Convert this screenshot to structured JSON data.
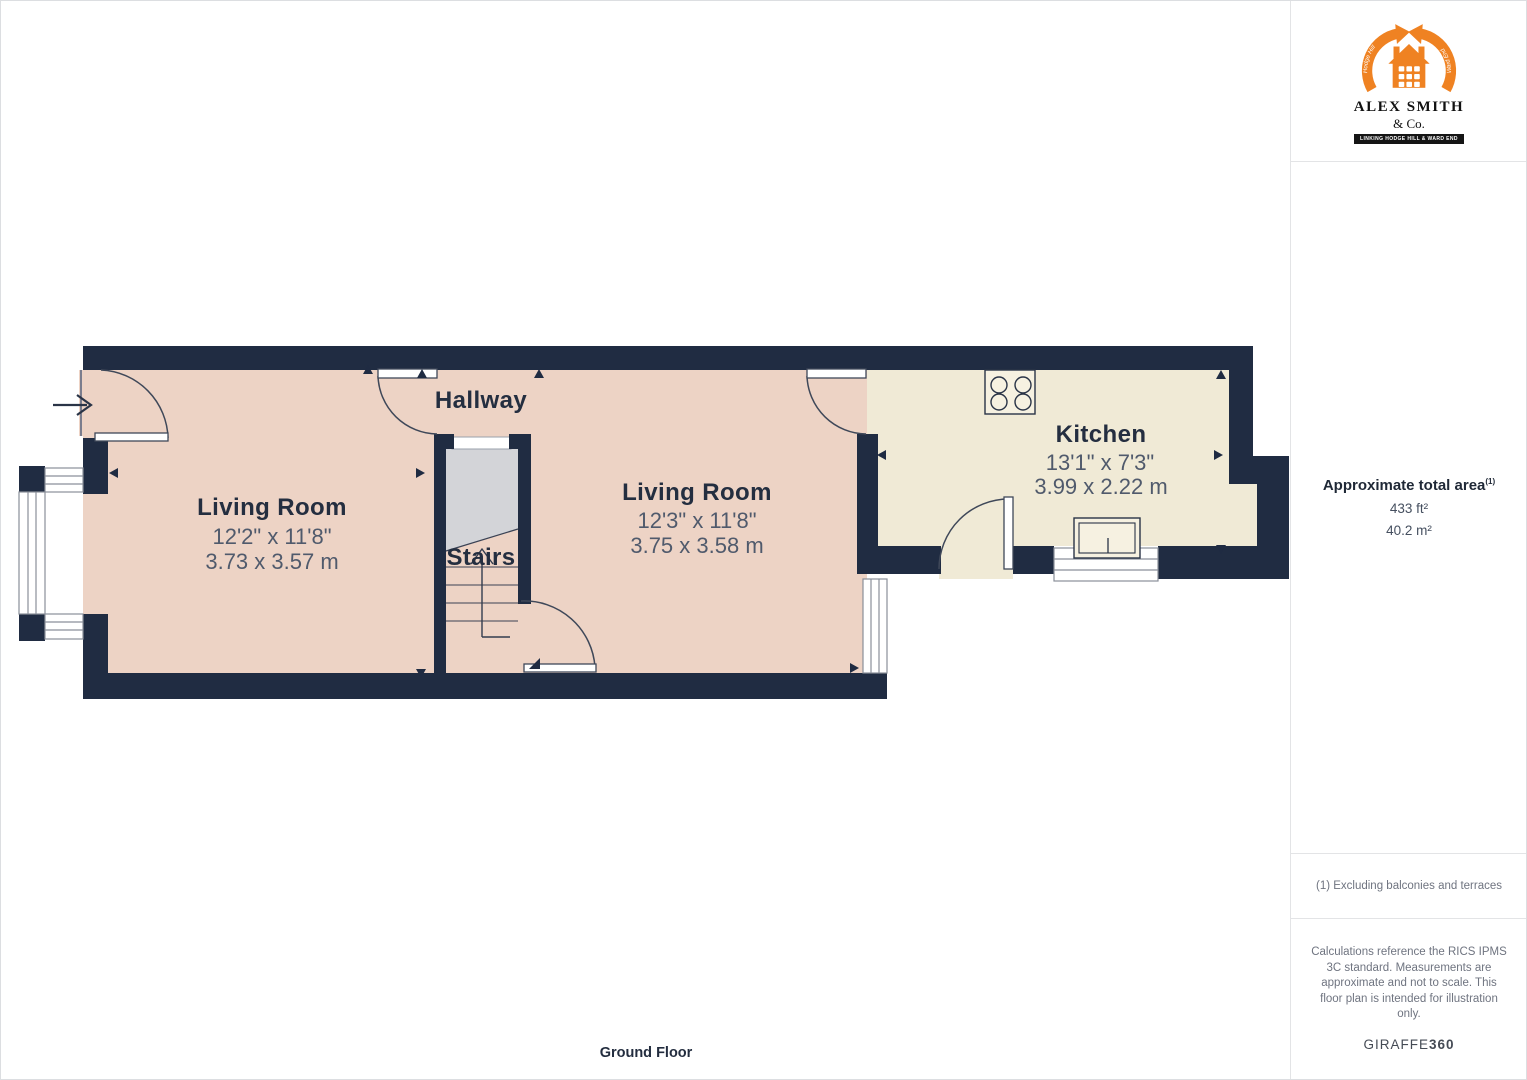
{
  "plan": {
    "floor_label": "Ground Floor",
    "rooms": [
      {
        "name": "Living Room",
        "dims_ft": "12'2\" x 11'8\"",
        "dims_m": "3.73 x 3.57 m"
      },
      {
        "name": "Hallway"
      },
      {
        "name": "Stairs"
      },
      {
        "name": "Living Room",
        "dims_ft": "12'3\" x 11'8\"",
        "dims_m": "3.75 x 3.58 m"
      },
      {
        "name": "Kitchen",
        "dims_ft": "13'1\" x 7'3\"",
        "dims_m": "3.99 x 2.22 m"
      }
    ],
    "colors": {
      "wall": "#202c42",
      "room_floor": "#edd3c5",
      "kitchen_floor": "#f0ead6",
      "stairs": "#d3d4d8",
      "accent_orange": "#ef8222"
    }
  },
  "sidebar": {
    "logo": {
      "name": "ALEX SMITH",
      "suffix": "& Co.",
      "banner": "LINKING HODGE HILL & WARD END",
      "arc_left_text": "Hodge Hill",
      "arc_right_text": "Ward End"
    },
    "area": {
      "title": "Approximate total area",
      "marker": "(1)",
      "sqft": "433 ft²",
      "sqm": "40.2 m²"
    },
    "footnote": "(1) Excluding balconies and terraces",
    "disclaimer": "Calculations reference the RICS IPMS 3C standard. Measurements are approximate and not to scale. This floor plan is intended for illustration only.",
    "brand": {
      "giraffe": "GIRAFFE",
      "threesixty": "360"
    }
  }
}
